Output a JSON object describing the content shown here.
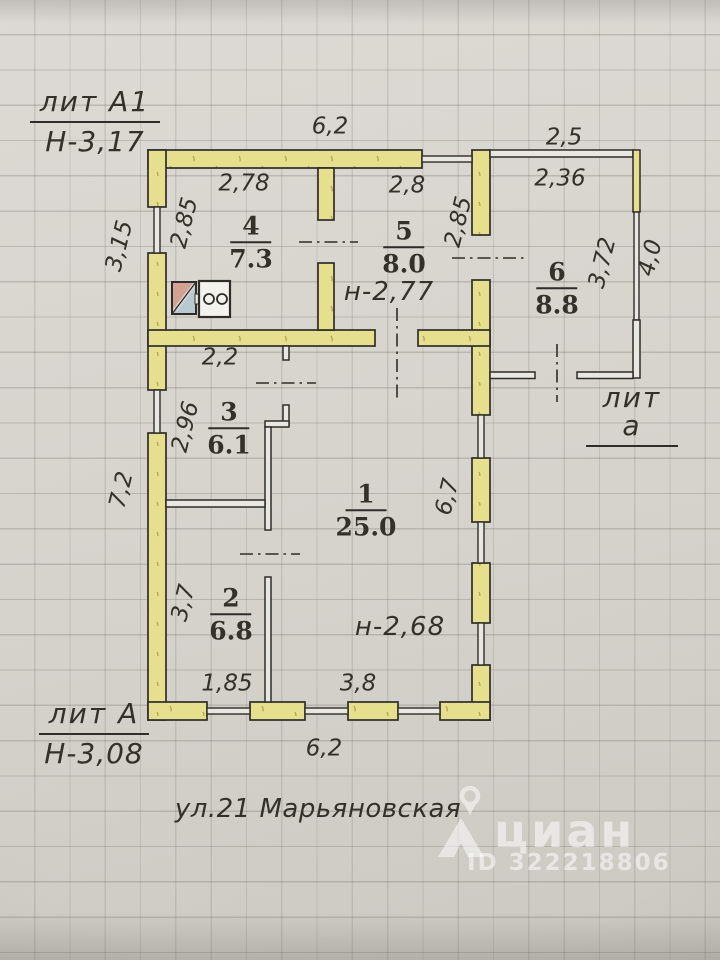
{
  "title_blocks": {
    "upper": {
      "lit": "лит А1",
      "height": "Н-3,17"
    },
    "lower": {
      "lit": "лит А",
      "height": "Н-3,08"
    },
    "annex": {
      "lit": "лит а"
    }
  },
  "street": "ул.21 Марьяновская",
  "rooms": {
    "r1": {
      "num": "1",
      "area": "25.0"
    },
    "r2": {
      "num": "2",
      "area": "6.8"
    },
    "r3": {
      "num": "3",
      "area": "6.1"
    },
    "r4": {
      "num": "4",
      "area": "7.3"
    },
    "r5": {
      "num": "5",
      "area": "8.0"
    },
    "r6": {
      "num": "6",
      "area": "8.8"
    }
  },
  "ceiling_heights": {
    "upper": "н-2,77",
    "lower": "н-2,68"
  },
  "dims": {
    "top_main": "6,2",
    "annex_top": "2,5",
    "room4_w": "2,78",
    "room5_w": "2,8",
    "room6_w": "2,36",
    "room4_h": "2,85",
    "room5_h": "2,85",
    "left_upper": "3,15",
    "room6_h": "3,72",
    "annex_right": "4,0",
    "room3_w": "2,2",
    "room3_h": "2,96",
    "left_lower": "7,2",
    "room1_h": "6,7",
    "room2_h": "3,7",
    "room2_bottom": "1,85",
    "room1_bottom": "3,8",
    "bottom_main": "6,2"
  },
  "watermark": {
    "brand": "циан",
    "listing_id": "ID 322218806"
  },
  "icons": {
    "sink": "sink-icon",
    "stove": "stove-icon",
    "pin": "location-pin-icon",
    "brand_glyph": "cian-house-logo-icon"
  },
  "colors": {
    "wall": "#e6df8e",
    "ink": "#2f2d29",
    "text": "#34302a",
    "paper": "#d8d5d0",
    "thin_fill": "#e9e7e2",
    "sink_pink": "#d4a293",
    "sink_blue": "#b9c9d2",
    "watermark": "rgba(255,255,255,0.52)"
  }
}
